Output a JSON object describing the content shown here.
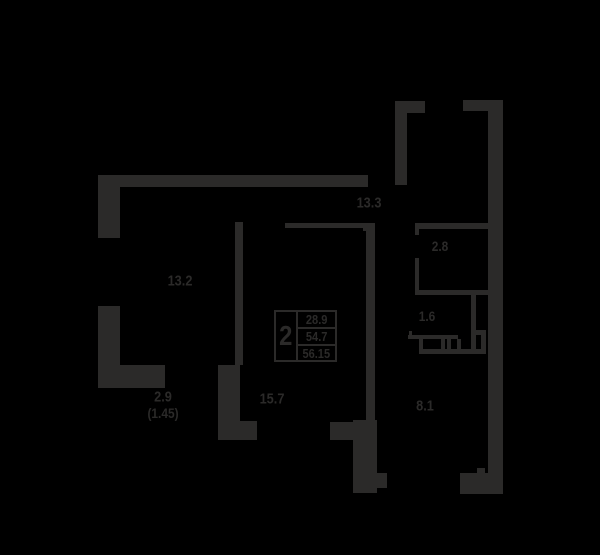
{
  "colors": {
    "background": "#000000",
    "wall": "#2b2a29"
  },
  "plan": {
    "summary": {
      "room_count": "2",
      "living_area": "28.9",
      "apartment_area": "54.7",
      "total_area": "56.15"
    },
    "rooms": {
      "hallway": "13.3",
      "bedroom": "13.2",
      "wardrobe": "2.8",
      "bathroom": "1.6",
      "living_room": "15.7",
      "kitchen": "8.1",
      "balcony": "2.9",
      "balcony_coefficient": "(1.45)"
    }
  }
}
